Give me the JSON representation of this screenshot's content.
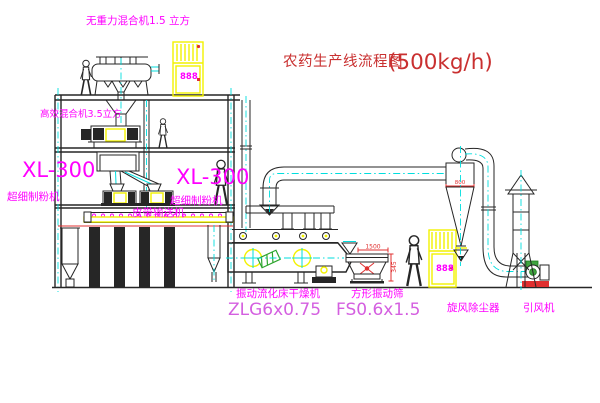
{
  "title": {
    "text": "农药生产线流程图",
    "capacity": "(500kg/h)"
  },
  "labels": {
    "mixer_top": "无重力混合机1.5 立方",
    "mixer_2f": "高效混合机3.5立方",
    "mill_left": {
      "model": "XL-300",
      "name": "超细制粉机"
    },
    "mill_right": {
      "model": "XL-300",
      "name": "超细制粉机"
    },
    "belt_conveyor": "皮带输送机",
    "dryer": {
      "name": "振动流化床干燥机",
      "model": "ZLG6x0.75"
    },
    "sieve": {
      "name": "方形振动筛",
      "model": "FS0.6x1.5"
    },
    "cyclone": "旋风除尘器",
    "fan": "引风机"
  },
  "dimensions": {
    "sieve_width": "1500",
    "sieve_height": "345",
    "cyclone_dia": "800"
  },
  "cabinets": {
    "display": "888"
  },
  "colors": {
    "label_magenta": "#ff00ff",
    "model_violet": "#d45fe0",
    "title_red": "#c93030",
    "equipment_yellow": "#f2f200",
    "centerline_cyan": "#00dede",
    "dim_red": "#e03030"
  }
}
